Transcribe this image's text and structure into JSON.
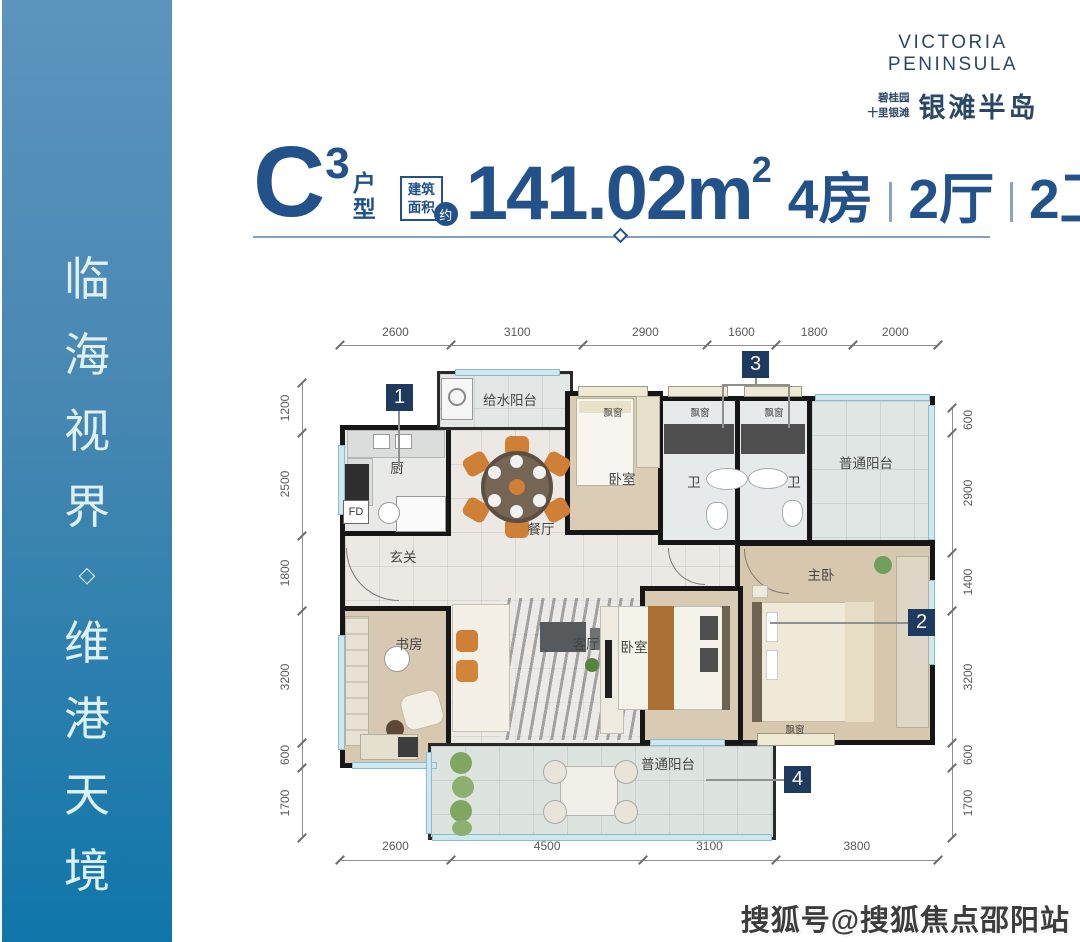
{
  "banner": {
    "text": "临海视界◇维港天境",
    "chars": [
      "临",
      "海",
      "视",
      "界",
      "◇",
      "维",
      "港",
      "天",
      "境"
    ]
  },
  "logo": {
    "name_en": "VICTORIA PENINSULA",
    "sub_line1": "碧桂园",
    "sub_line2": "十里银滩",
    "name_cn": "银滩半岛"
  },
  "title": {
    "unit_letter": "C",
    "unit_sup": "3",
    "unit_word_1": "户",
    "unit_word_2": "型",
    "area_box_line1": "建筑",
    "area_box_line2": "面积",
    "area_approx": "约",
    "area_value": "141.02m",
    "area_unit_sup": "2",
    "spec_rooms": "4房",
    "spec_halls": "2厅",
    "spec_baths": "2卫"
  },
  "floor_plan": {
    "markers": [
      "1",
      "2",
      "3",
      "4"
    ],
    "labels": {
      "water_balcony": "给水阳台",
      "kitchen": "厨",
      "fd": "FD",
      "foyer": "玄关",
      "dining": "餐厅",
      "bedroom": "卧室",
      "bay_window": "飘窗",
      "bath": "卫",
      "common_balcony": "普通阳台",
      "study": "书房",
      "living": "客厅",
      "master_bedroom": "主卧"
    },
    "dimensions": {
      "top": [
        2600,
        3100,
        2900,
        1600,
        1800,
        2000
      ],
      "bottom": [
        2600,
        4500,
        3100,
        3800
      ],
      "left": [
        1200,
        2500,
        1800,
        3200,
        600,
        1700
      ],
      "right": [
        600,
        2900,
        1400,
        3200,
        600,
        1700
      ]
    }
  },
  "watermark": "搜狐号@搜狐焦点邵阳站",
  "colors": {
    "navy": "#23528a",
    "badge_navy": "#1e3a5e",
    "banner_top": "#5d94be",
    "banner_bottom": "#1076a9",
    "banner_text": "#def0f8"
  }
}
